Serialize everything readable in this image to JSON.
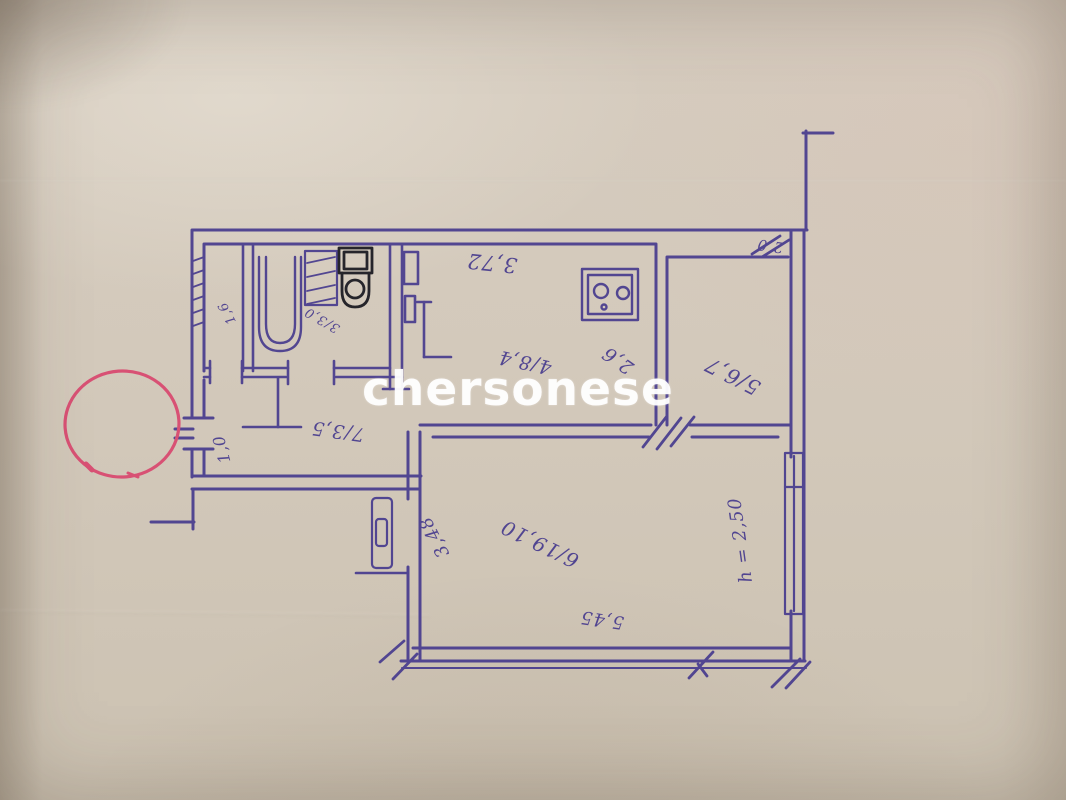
{
  "photo": {
    "colors": {
      "paper": "#d3c9bb",
      "ink": "#4a3e93",
      "dark_ink": "#1c1b22",
      "red_marker": "#df4870",
      "watermark_white": "#ffffff"
    }
  },
  "watermark": {
    "text": "chersonese"
  },
  "plan_labels": {
    "kitchen_width": "3,72",
    "kitchen_depth": "2,6",
    "corner_mark": "2,0",
    "room5_number_area": "5/6,7",
    "kitchen_number_area": "4/8,4",
    "hall_number_area": "7/3,5",
    "entrance_width": "1,0",
    "wc_area": "1,6",
    "bath_number_area": "3/3,0",
    "living_wall_dim": "3,48",
    "living_number_area": "6/19,10",
    "living_width": "5,45",
    "ceiling_height": "h = 2,50"
  }
}
